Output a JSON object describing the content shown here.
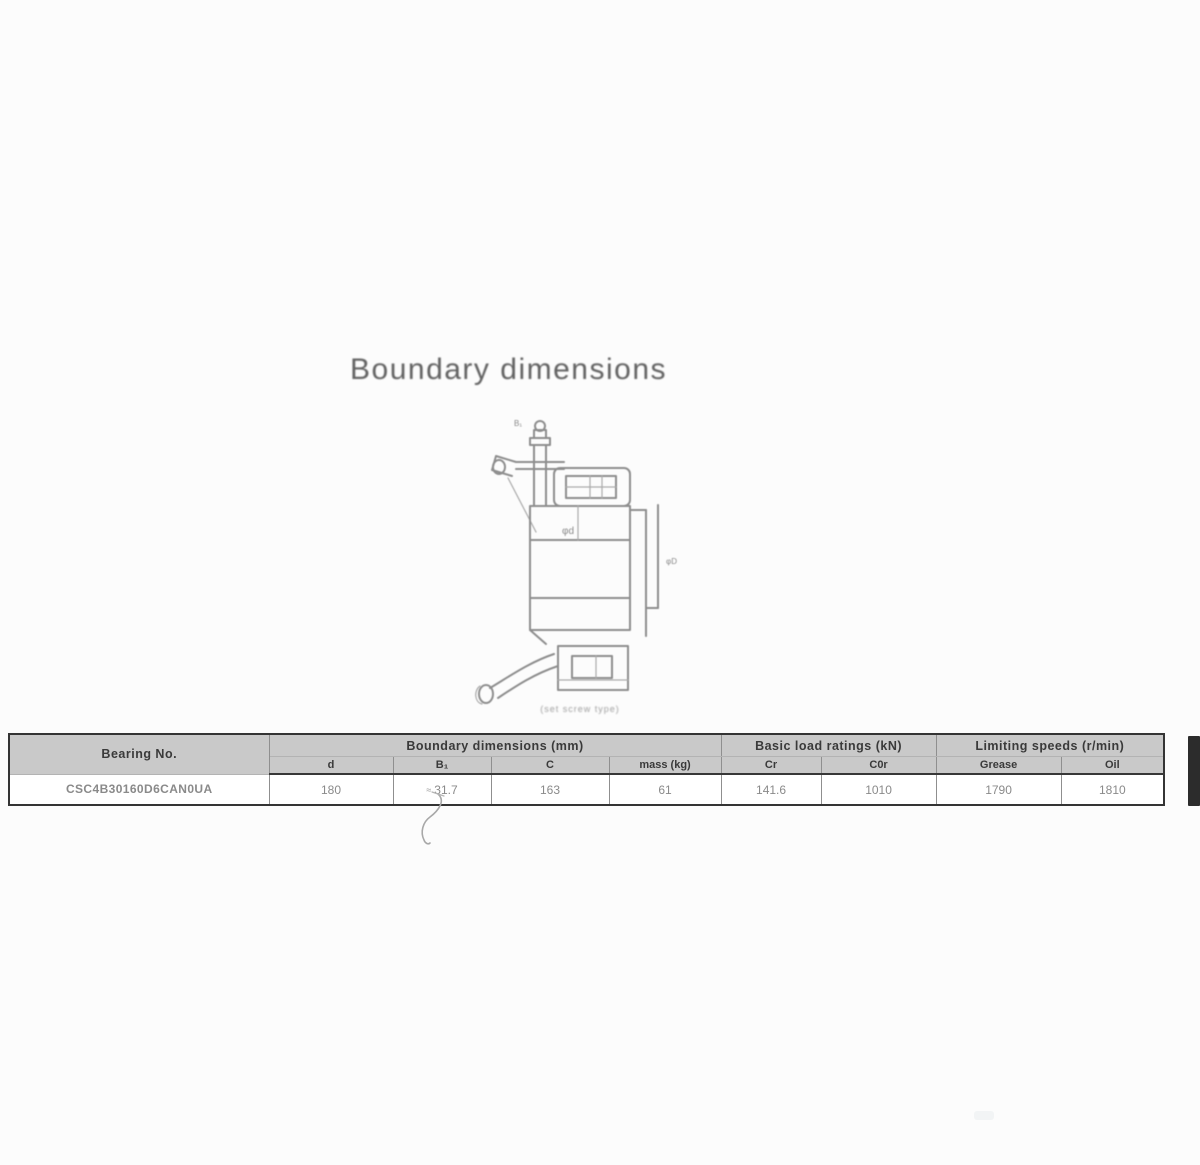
{
  "page_title": "Boundary dimensions",
  "figure": {
    "labels": {
      "top": "B₁",
      "bore": "φd",
      "outside": "φD"
    },
    "caption": "(set screw type)"
  },
  "table": {
    "groups": {
      "bearing_no": "Bearing No.",
      "boundary": "Boundary dimensions (mm)",
      "load": "Basic load ratings (kN)",
      "speed": "Limiting speeds (r/min)"
    },
    "sub_headers": [
      "d",
      "B₁",
      "C",
      "mass (kg)",
      "Cr",
      "C0r",
      "Grease",
      "Oil"
    ],
    "footnote_marker": "≈",
    "row": {
      "bearing_no": "CSC4B30160D6CAN0UA",
      "d": "180",
      "B1": "31.7",
      "C": "163",
      "mass": "61",
      "Cr": "141.6",
      "C0r": "1010",
      "grease": "1790",
      "oil": "1810"
    }
  }
}
